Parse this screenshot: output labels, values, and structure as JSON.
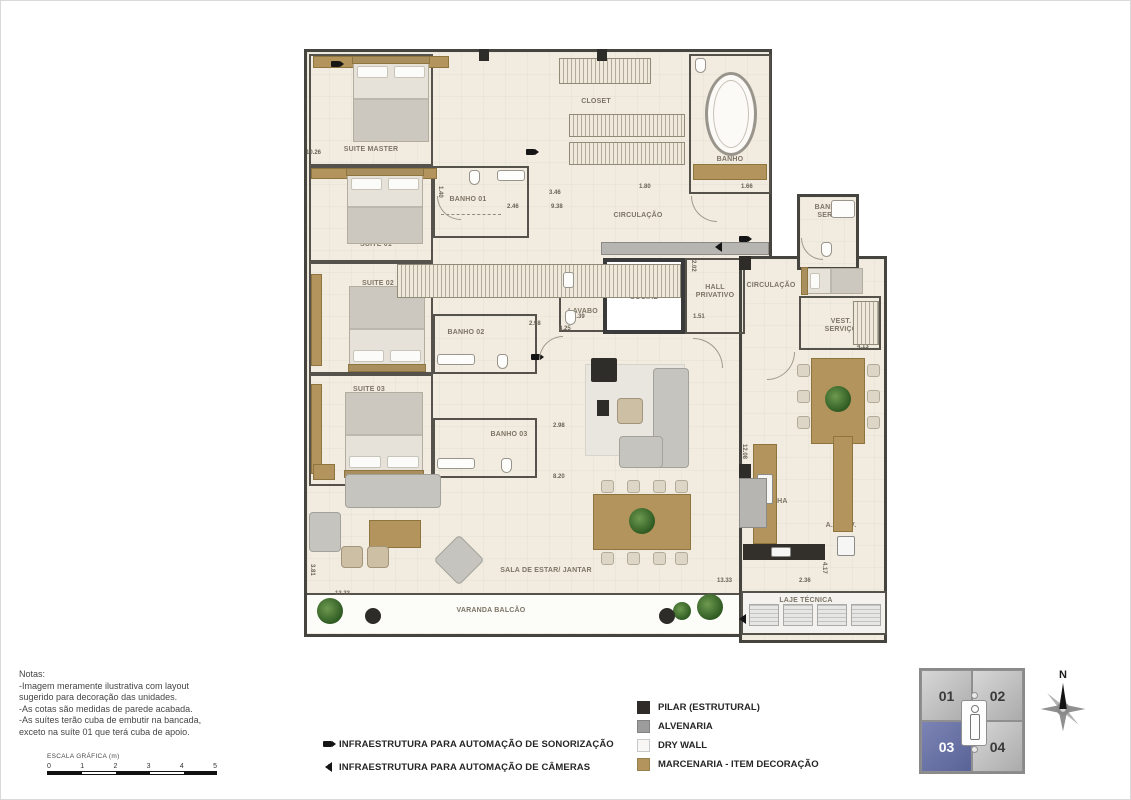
{
  "plan": {
    "rooms": {
      "suite_master": "SUITE MASTER",
      "suite_01": "SUITE 01",
      "suite_02": "SUITE 02",
      "suite_03": "SUITE 03",
      "banho_01": "BANHO 01",
      "banho_02": "BANHO 02",
      "banho_03": "BANHO 03",
      "banho": "BANHO",
      "banho_serv": "BANHO SERV.",
      "closet_a": "CLOSET",
      "closet_b": "CLOSET",
      "circulacao_top": "CIRCULAÇÃO",
      "circulacao_right": "CIRCULAÇÃO",
      "circ": "CIRC.",
      "lavabo": "LAVABO",
      "elevador_social": "ELEVADOR SOCIAL",
      "hall_privativo": "HALL PRIVATIVO",
      "vest_servico": "VEST. SERVIÇO",
      "copa": "COPA",
      "cozinha": "COZINHA",
      "a_serv": "A. SERV.",
      "laje_tecnica": "LAJE TÉCNICA",
      "sala": "SALA DE ESTAR/ JANTAR",
      "varanda": "VARANDA BALCÃO"
    },
    "dimensions": [
      "10.26",
      "1.40",
      "2.46",
      "3.46",
      "9.38",
      "1.80",
      "1.66",
      "2.02",
      "1.39",
      "8.25",
      "1.51",
      "2.98",
      "2.98",
      "8.20",
      "4.13",
      "12.08",
      "2.36",
      "4.17",
      "13.33",
      "13.33",
      "3.81"
    ]
  },
  "notes": {
    "title": "Notas:",
    "lines": [
      "-Imagem meramente ilustrativa com layout",
      "sugerido para decoração das unidades.",
      "-As cotas são medidas de parede acabada.",
      "-As suítes terão  cuba de embutir na bancada,",
      "exceto na suíte 01 que terá cuba de apoio."
    ]
  },
  "scale": {
    "label": "ESCALA GRÁFICA (m)",
    "ticks": [
      "0",
      "1",
      "2",
      "3",
      "4",
      "5"
    ]
  },
  "legend": {
    "automation": [
      {
        "icon": "camera-icon",
        "label": "INFRAESTRUTURA PARA AUTOMAÇÃO DE SONORIZAÇÃO"
      },
      {
        "icon": "speaker-icon",
        "label": "INFRAESTRUTURA PARA AUTOMAÇÃO DE CÂMERAS"
      }
    ],
    "materials": [
      {
        "color": "#2e2b28",
        "label": "PILAR (ESTRUTURAL)"
      },
      {
        "color": "#9c9c9c",
        "label": "ALVENARIA"
      },
      {
        "color": "#f8f7f5",
        "label": "DRY WALL"
      },
      {
        "color": "#b2945c",
        "label": "MARCENARIA - ITEM DECORAÇÃO"
      }
    ]
  },
  "keyplan": {
    "units": [
      {
        "id": "01"
      },
      {
        "id": "02"
      },
      {
        "id": "03"
      },
      {
        "id": "04"
      }
    ],
    "active": "03"
  },
  "compass": {
    "north": "N"
  }
}
